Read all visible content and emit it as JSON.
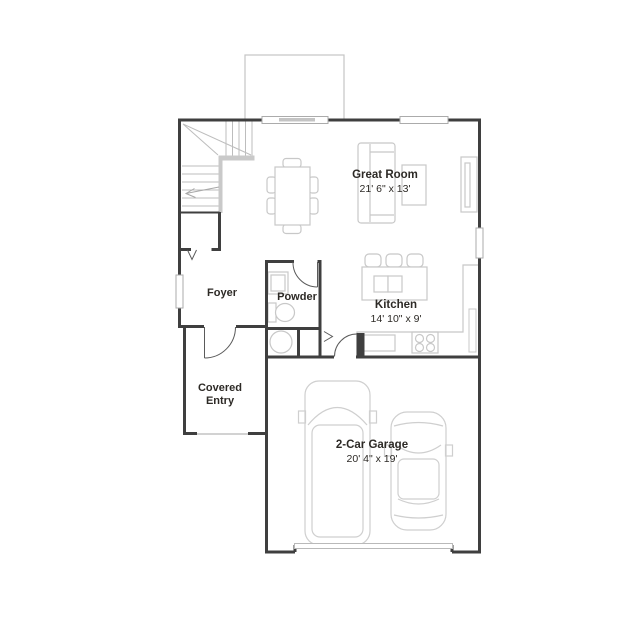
{
  "rooms": {
    "great_room": {
      "name": "Great Room",
      "dimensions": "21' 6\" x 13'"
    },
    "kitchen": {
      "name": "Kitchen",
      "dimensions": "14' 10\" x 9'"
    },
    "garage": {
      "name": "2-Car Garage",
      "dimensions": "20' 4\" x 19'"
    },
    "foyer": {
      "name": "Foyer"
    },
    "powder": {
      "name": "Powder"
    },
    "covered_entry": {
      "name": "Covered Entry"
    }
  },
  "fixtures": [
    "staircase",
    "stair-direction-arrow",
    "coat-closet",
    "front-door",
    "patio",
    "sliding-patio-door",
    "dining-table",
    "dining-chairs",
    "sofa",
    "coffee-table",
    "media-console",
    "kitchen-island",
    "bar-stools",
    "island-sink",
    "range",
    "dishwasher",
    "kitchen-counter",
    "pantry",
    "vanity-sink",
    "toilet",
    "water-heater",
    "garage-door",
    "pickup-truck",
    "car",
    "windows"
  ],
  "colors": {
    "wall": "#3f3f3f",
    "furniture_outline": "#c8c8c8",
    "label_text": "#2d2a26",
    "background": "#ffffff"
  }
}
